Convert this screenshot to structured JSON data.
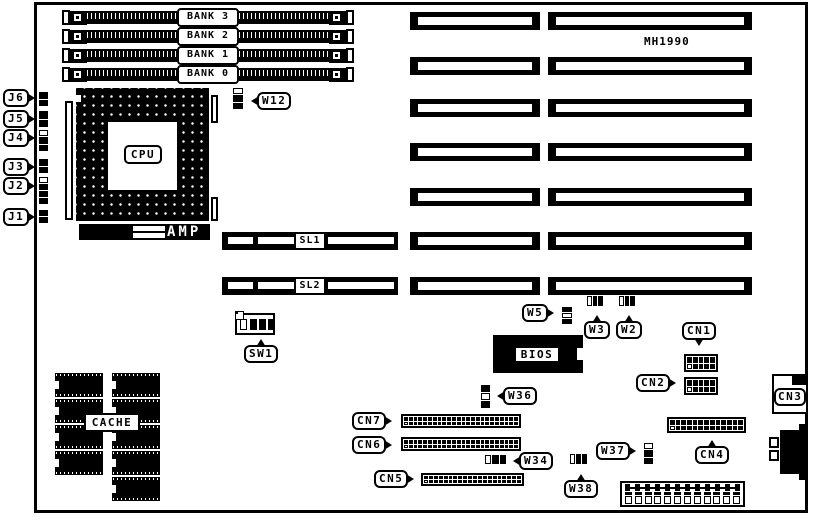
{
  "diagram": {
    "model": "MH1990"
  },
  "memory": {
    "banks": [
      {
        "label": "BANK 3"
      },
      {
        "label": "BANK 2"
      },
      {
        "label": "BANK 1"
      },
      {
        "label": "BANK 0"
      }
    ]
  },
  "cpu": {
    "label": "CPU",
    "amp": "AMP"
  },
  "slots": {
    "sl1": "SL1",
    "sl2": "SL2"
  },
  "edge_connectors": {
    "j6": "J6",
    "j5": "J5",
    "j4": "J4",
    "j3": "J3",
    "j2": "J2",
    "j1": "J1"
  },
  "jumpers": {
    "w12": "W12",
    "w5": "W5",
    "w3": "W3",
    "w2": "W2",
    "w36": "W36",
    "w34": "W34",
    "w37": "W37",
    "w38": "W38"
  },
  "connectors": {
    "cn1": "CN1",
    "cn2": "CN2",
    "cn3": "CN3",
    "cn4": "CN4",
    "cn5": "CN5",
    "cn6": "CN6",
    "cn7": "CN7"
  },
  "switches": {
    "sw1": "SW1"
  },
  "chips": {
    "bios": "BIOS",
    "cache": "CACHE"
  },
  "colors": {
    "ink": "#000000",
    "paper": "#ffffff"
  }
}
